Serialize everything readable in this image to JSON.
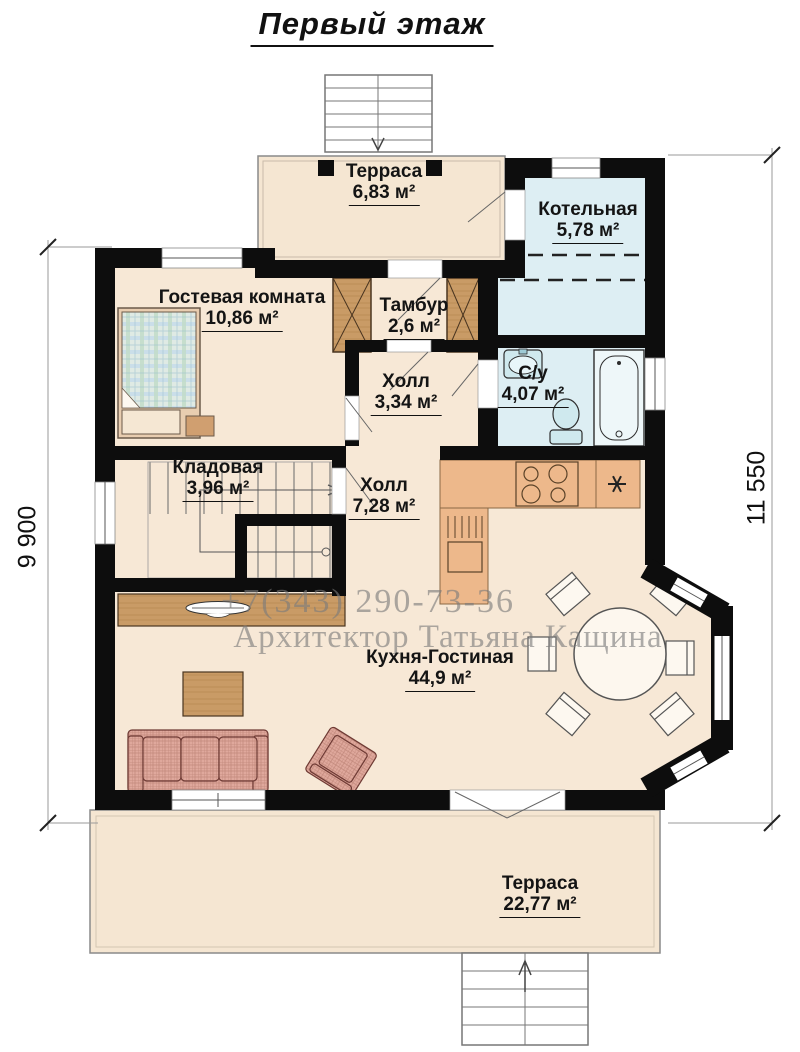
{
  "title": "Первый этаж",
  "rooms": {
    "terrace_top": {
      "name": "Терраса",
      "area": "6,83 м²"
    },
    "boiler": {
      "name": "Котельная",
      "area": "5,78 м²"
    },
    "guest": {
      "name": "Гостевая комната",
      "area": "10,86 м²"
    },
    "tambour": {
      "name": "Тамбур",
      "area": "2,6 м²"
    },
    "hall_small": {
      "name": "Холл",
      "area": "3,34 м²"
    },
    "bathroom": {
      "name": "С/у",
      "area": "4,07 м²"
    },
    "storage": {
      "name": "Кладовая",
      "area": "3,96 м²"
    },
    "hall_big": {
      "name": "Холл",
      "area": "7,28 м²"
    },
    "kitchen_living": {
      "name": "Кухня-Гостиная",
      "area": "44,9 м²"
    },
    "terrace_bottom": {
      "name": "Терраса",
      "area": "22,77 м²"
    }
  },
  "dimensions": {
    "left": "9 900",
    "right": "11 550"
  },
  "watermark": {
    "phone": "+7(343) 290-73-36",
    "architect": "Архитектор Татьяна Кащина"
  },
  "colors": {
    "wall": "#0d0d0d",
    "floor": "#f7e8d6",
    "wet_room": "#ddeef3",
    "wood": "#c99b66",
    "counter": "#edb88b",
    "sofa": "#e0a89d",
    "fixture": "#cfe9ee",
    "label": "#141414"
  }
}
